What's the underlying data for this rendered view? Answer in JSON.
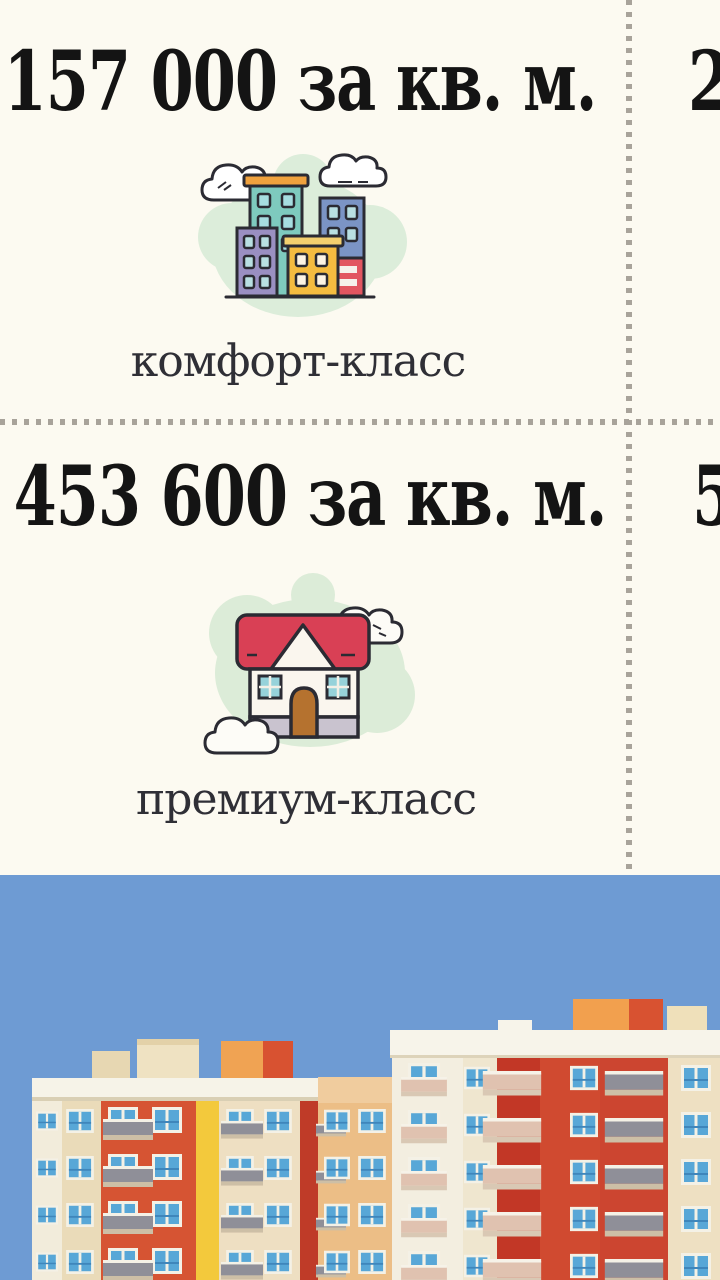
{
  "grid": {
    "cells": [
      {
        "id": "comfort",
        "price": "157 000 за кв. м.",
        "label": "комфорт-класс",
        "icon": "city-buildings-icon"
      },
      {
        "id": "adjacent-column-top",
        "price_partial": "2"
      },
      {
        "id": "premium",
        "price": "453 600 за кв. м.",
        "label": "премиум-класс",
        "icon": "house-icon"
      },
      {
        "id": "adjacent-column-bottom",
        "price_partial": "5"
      }
    ]
  },
  "illustration": {
    "name": "apartment-buildings-illustration"
  },
  "colors": {
    "background": "#fcfaf1",
    "price_text": "#141414",
    "label_text": "#2f2f36",
    "divider_dot": "#a8a39a",
    "sky": "#6e9bd3",
    "building_red": "#d14a30",
    "building_deep_red": "#bf3b28",
    "building_yellow": "#f3c93c",
    "building_cream": "#eedfc2",
    "building_white": "#f3eee0",
    "building_tan": "#ecbe86",
    "window_blue": "#58a7d7",
    "railing_gray": "#8f8f98",
    "railing_salmon": "#e0c2b0",
    "icon_green_blob": "#dcedda",
    "icon_outline": "#2b2b33",
    "icon_teal_building": "#7ecabe",
    "icon_purple_building": "#9a8fc2",
    "icon_blue_building": "#7b94c5",
    "icon_yellow_building": "#f5bc40",
    "icon_orange_roof": "#f0a23e",
    "icon_red_accent": "#e25560",
    "icon_house_roof_red": "#d94055",
    "icon_house_door_brown": "#b5722f",
    "icon_house_foundation": "#c9c3cf",
    "icon_window_teal": "#96d2da"
  }
}
